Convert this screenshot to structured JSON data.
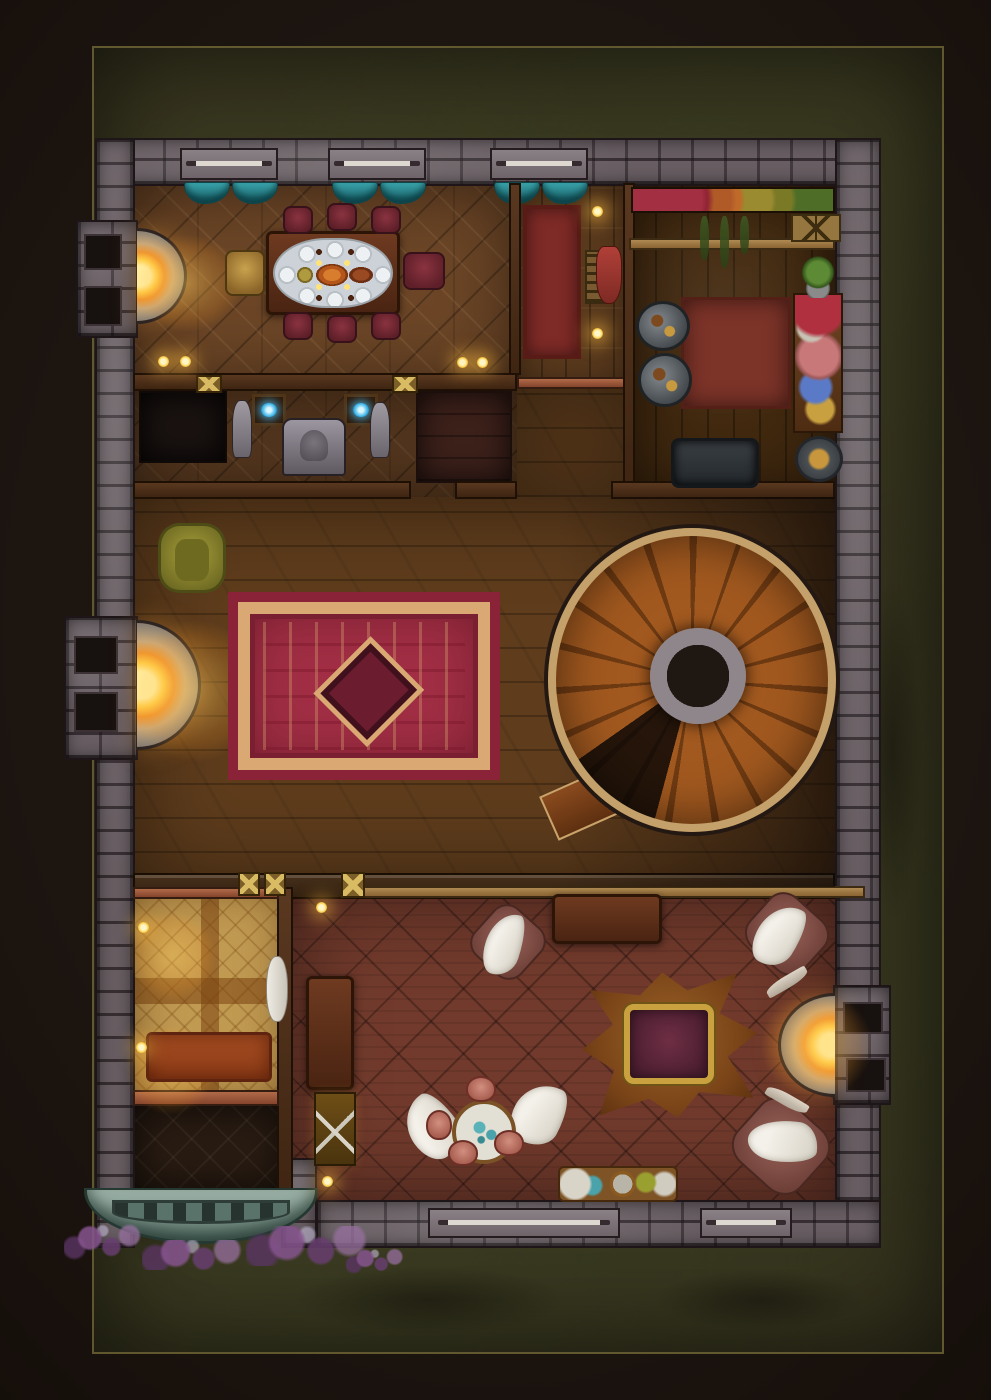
{
  "scene": {
    "title": "Top-down fantasy battle map: tavern-manor ground floor at night",
    "canvas": {
      "width": 991,
      "height": 1400
    },
    "rooms": [
      "dining room with set table",
      "hallway with red runner",
      "kitchen",
      "shrine corridor with orb paintings",
      "living room with large rug and spiral staircase",
      "bedroom with golden parquet",
      "entry vestibule with stone porch",
      "trophy lounge with bear rug, throne and round table"
    ]
  },
  "palette": {
    "background": "#120c08",
    "grass": "#36331e",
    "stone_wall": "#675d62",
    "dining_parquet": "#6b4526",
    "living_floor": "#5e3c1c",
    "tavern_floor": "#713a2c",
    "bedroom_floor": "#c19a52",
    "rug_red": "#a12e44",
    "rug_trim": "#d9a873",
    "runner_red": "#7e2a26",
    "curtain_teal": "#2e8f96",
    "fire_glow": "#ffc93e",
    "chair_maroon": "#7c2a33",
    "chair_gold": "#b9903f",
    "armchair_green": "#97922f",
    "stair_wood": "#a2591f",
    "stair_rim": "#c4a06a",
    "porch_stone": "#8ba399",
    "vine_purple": "#7a5070",
    "orb_blue": "#49b8e8",
    "animal_white": "#f2efe8",
    "throne_gold": "#c9a23f",
    "bear_rug": "#8a5120"
  },
  "regions": [
    {
      "n": "ground-grass",
      "c": "grass",
      "x": 92,
      "y": 46,
      "w": 852,
      "h": 1308
    },
    {
      "n": "grass-patch",
      "c": "grass-patch",
      "x": 110,
      "y": 220,
      "w": 200,
      "h": 260
    },
    {
      "n": "grass-patch",
      "c": "grass-patch",
      "x": 650,
      "y": 180,
      "w": 240,
      "h": 300
    },
    {
      "n": "grass-patch",
      "c": "grass-patch",
      "x": 120,
      "y": 760,
      "w": 150,
      "h": 360
    },
    {
      "n": "grass-patch",
      "c": "grass-patch",
      "x": 852,
      "y": 520,
      "w": 80,
      "h": 460
    },
    {
      "n": "grass-patch",
      "c": "grass-patch",
      "x": 250,
      "y": 1255,
      "w": 360,
      "h": 90
    },
    {
      "n": "grass-patch",
      "c": "grass-patch",
      "x": 620,
      "y": 1260,
      "w": 280,
      "h": 80
    },
    {
      "n": "grass-patch",
      "c": "grass-patch",
      "x": 96,
      "y": 1060,
      "w": 120,
      "h": 240
    },
    {
      "n": "floor-dining-room",
      "c": "floor-parquet",
      "x": 133,
      "y": 183,
      "w": 384,
      "h": 206
    },
    {
      "n": "floor-hallway",
      "c": "floor-planks",
      "x": 517,
      "y": 183,
      "w": 112,
      "h": 206
    },
    {
      "n": "floor-kitchen",
      "c": "floor-kitchen",
      "x": 629,
      "y": 183,
      "w": 206,
      "h": 314
    },
    {
      "n": "floor-shrine-corridor",
      "c": "floor-parquet dark",
      "x": 133,
      "y": 389,
      "w": 384,
      "h": 108
    },
    {
      "n": "floor-landing",
      "c": "floor-living",
      "x": 517,
      "y": 389,
      "w": 112,
      "h": 108
    },
    {
      "n": "floor-living-room",
      "c": "floor-living",
      "x": 133,
      "y": 497,
      "w": 702,
      "h": 390
    },
    {
      "n": "floor-bedroom",
      "c": "floor-bedroom",
      "x": 133,
      "y": 887,
      "w": 154,
      "h": 217
    },
    {
      "n": "floor-vestibule",
      "c": "floor-vestibule",
      "x": 133,
      "y": 1104,
      "w": 154,
      "h": 88
    },
    {
      "n": "floor-tavern-lounge",
      "c": "floor-tavern",
      "x": 287,
      "y": 887,
      "w": 548,
      "h": 317
    },
    {
      "n": "floor-closet",
      "c": "floor-dark",
      "x": 139,
      "y": 391,
      "w": 88,
      "h": 72
    },
    {
      "n": "floor-storage-room",
      "c": "floor-darkred",
      "x": 416,
      "y": 391,
      "w": 96,
      "h": 92
    },
    {
      "n": "wall-north",
      "c": "wall-stone",
      "x": 95,
      "y": 138,
      "w": 786,
      "h": 48
    },
    {
      "n": "wall-west",
      "c": "wall-stone",
      "x": 95,
      "y": 138,
      "w": 40,
      "h": 1110
    },
    {
      "n": "wall-east",
      "c": "wall-stone",
      "x": 835,
      "y": 138,
      "w": 46,
      "h": 1110
    },
    {
      "n": "wall-south",
      "c": "wall-stone",
      "x": 316,
      "y": 1200,
      "w": 565,
      "h": 48
    },
    {
      "n": "chimney-dining",
      "c": "wall-stone",
      "x": 76,
      "y": 220,
      "w": 62,
      "h": 118
    },
    {
      "n": "chimney-living",
      "c": "wall-stone",
      "x": 64,
      "y": 616,
      "w": 74,
      "h": 144
    },
    {
      "n": "chimney-tavern",
      "c": "wall-stone",
      "x": 833,
      "y": 985,
      "w": 58,
      "h": 120
    },
    {
      "n": "stone-post-door",
      "c": "wall-stone",
      "x": 281,
      "y": 1158,
      "w": 36,
      "h": 90
    },
    {
      "n": "flue",
      "c": "flue",
      "x": 84,
      "y": 234,
      "w": 38,
      "h": 36
    },
    {
      "n": "flue",
      "c": "flue",
      "x": 84,
      "y": 286,
      "w": 38,
      "h": 40
    },
    {
      "n": "flue",
      "c": "flue",
      "x": 74,
      "y": 636,
      "w": 44,
      "h": 38
    },
    {
      "n": "flue",
      "c": "flue",
      "x": 74,
      "y": 692,
      "w": 44,
      "h": 40
    },
    {
      "n": "flue",
      "c": "flue",
      "x": 843,
      "y": 1002,
      "w": 40,
      "h": 32
    },
    {
      "n": "flue",
      "c": "flue",
      "x": 846,
      "y": 1058,
      "w": 40,
      "h": 34
    },
    {
      "n": "window-north-1",
      "c": "window-sill",
      "x": 180,
      "y": 148,
      "w": 98,
      "h": 32
    },
    {
      "n": "window-north-2",
      "c": "window-sill",
      "x": 328,
      "y": 148,
      "w": 98,
      "h": 32
    },
    {
      "n": "window-north-3",
      "c": "window-sill",
      "x": 490,
      "y": 148,
      "w": 98,
      "h": 32
    },
    {
      "n": "window-south-1",
      "c": "window-sill",
      "x": 428,
      "y": 1208,
      "w": 192,
      "h": 30
    },
    {
      "n": "window-south-2",
      "c": "window-sill",
      "x": 700,
      "y": 1208,
      "w": 92,
      "h": 30
    },
    {
      "n": "curtain",
      "c": "curtain",
      "x": 184,
      "y": 182,
      "w": 46,
      "h": 22
    },
    {
      "n": "curtain",
      "c": "curtain",
      "x": 232,
      "y": 182,
      "w": 46,
      "h": 22
    },
    {
      "n": "curtain",
      "c": "curtain",
      "x": 332,
      "y": 182,
      "w": 46,
      "h": 22
    },
    {
      "n": "curtain",
      "c": "curtain",
      "x": 380,
      "y": 182,
      "w": 46,
      "h": 22
    },
    {
      "n": "curtain",
      "c": "curtain",
      "x": 494,
      "y": 182,
      "w": 46,
      "h": 22
    },
    {
      "n": "curtain",
      "c": "curtain",
      "x": 542,
      "y": 182,
      "w": 46,
      "h": 22
    },
    {
      "n": "wall-dining-south",
      "c": "wall-wood",
      "x": 133,
      "y": 373,
      "w": 384,
      "h": 18
    },
    {
      "n": "beam-hallway",
      "c": "beam-copper",
      "x": 517,
      "y": 377,
      "w": 112,
      "h": 12
    },
    {
      "n": "wall-dining-hallway",
      "c": "wall-wood",
      "x": 509,
      "y": 183,
      "w": 12,
      "h": 192
    },
    {
      "n": "wall-hallway-kitchen",
      "c": "wall-wood",
      "x": 623,
      "y": 183,
      "w": 12,
      "h": 314
    },
    {
      "n": "beam-kitchen-counter",
      "c": "beam-tan",
      "x": 629,
      "y": 238,
      "w": 206,
      "h": 12
    },
    {
      "n": "wall-corridor-south-a",
      "c": "wall-wood",
      "x": 133,
      "y": 481,
      "w": 278,
      "h": 18
    },
    {
      "n": "wall-corridor-south-b",
      "c": "wall-wood",
      "x": 455,
      "y": 481,
      "w": 62,
      "h": 18
    },
    {
      "n": "wall-kitchen-south",
      "c": "wall-wood",
      "x": 611,
      "y": 481,
      "w": 224,
      "h": 18
    },
    {
      "n": "wall-living-south",
      "c": "wall-wood-dark",
      "x": 133,
      "y": 873,
      "w": 702,
      "h": 26
    },
    {
      "n": "beam-tavern",
      "c": "beam-tan",
      "x": 341,
      "y": 886,
      "w": 524,
      "h": 12
    },
    {
      "n": "wall-bedroom-tavern",
      "c": "wall-wood",
      "x": 277,
      "y": 887,
      "w": 16,
      "h": 317
    },
    {
      "n": "trim-bedroom-north",
      "c": "beam-copper",
      "x": 133,
      "y": 887,
      "w": 146,
      "h": 12
    },
    {
      "n": "trim-bedroom-south",
      "c": "beam-copper",
      "x": 133,
      "y": 1090,
      "w": 146,
      "h": 16
    },
    {
      "n": "wall-post-ornament",
      "c": "post-gold",
      "x": 196,
      "y": 375,
      "w": 26,
      "h": 18
    },
    {
      "n": "wall-post-ornament",
      "c": "post-gold",
      "x": 392,
      "y": 375,
      "w": 26,
      "h": 18
    },
    {
      "n": "wall-post-ornament",
      "c": "post-gold",
      "x": 238,
      "y": 872,
      "w": 22,
      "h": 24
    },
    {
      "n": "wall-post-ornament",
      "c": "post-gold",
      "x": 264,
      "y": 872,
      "w": 22,
      "h": 24
    },
    {
      "n": "wall-post-ornament",
      "c": "post-gold",
      "x": 341,
      "y": 872,
      "w": 24,
      "h": 26
    }
  ],
  "items": [
    {
      "n": "fireplace-dining",
      "c": "hearth-right",
      "x": 137,
      "y": 228,
      "w": 50,
      "h": 96
    },
    {
      "n": "fire-glow-dining",
      "c": "light-glow",
      "x": 112,
      "y": 218,
      "w": 150,
      "h": 130
    },
    {
      "n": "dining-table",
      "c": "table-wood",
      "x": 266,
      "y": 231,
      "w": 134,
      "h": 84
    },
    {
      "n": "dining-tablecloth",
      "c": "cloth",
      "x": 273,
      "y": 238,
      "w": 120,
      "h": 70
    },
    {
      "n": "dining-chair",
      "c": "chair-maroon",
      "x": 283,
      "y": 206,
      "w": 30,
      "h": 28
    },
    {
      "n": "dining-chair",
      "c": "chair-maroon",
      "x": 327,
      "y": 203,
      "w": 30,
      "h": 28
    },
    {
      "n": "dining-chair",
      "c": "chair-maroon",
      "x": 371,
      "y": 206,
      "w": 30,
      "h": 28
    },
    {
      "n": "dining-chair",
      "c": "chair-maroon",
      "x": 283,
      "y": 312,
      "w": 30,
      "h": 28
    },
    {
      "n": "dining-chair",
      "c": "chair-maroon",
      "x": 327,
      "y": 315,
      "w": 30,
      "h": 28
    },
    {
      "n": "dining-chair",
      "c": "chair-maroon",
      "x": 371,
      "y": 312,
      "w": 30,
      "h": 28
    },
    {
      "n": "dining-armchair",
      "c": "chair-maroon",
      "x": 403,
      "y": 252,
      "w": 42,
      "h": 38
    },
    {
      "n": "dining-head-chair",
      "c": "chair-gold",
      "x": 225,
      "y": 250,
      "w": 40,
      "h": 46
    },
    {
      "n": "wall-candle",
      "c": "candle",
      "x": 158,
      "y": 356,
      "w": 11,
      "h": 11
    },
    {
      "n": "wall-candle",
      "c": "candle",
      "x": 180,
      "y": 356,
      "w": 11,
      "h": 11
    },
    {
      "n": "wall-candle",
      "c": "candle",
      "x": 457,
      "y": 357,
      "w": 11,
      "h": 11
    },
    {
      "n": "wall-candle",
      "c": "candle",
      "x": 477,
      "y": 357,
      "w": 11,
      "h": 11
    },
    {
      "n": "runner-rug",
      "c": "rug-runner",
      "x": 523,
      "y": 205,
      "w": 58,
      "h": 154
    },
    {
      "n": "shelf-rack",
      "c": "rack-shelf",
      "x": 585,
      "y": 250,
      "w": 26,
      "h": 54
    },
    {
      "n": "wall-candle",
      "c": "candle",
      "x": 592,
      "y": 206,
      "w": 11,
      "h": 11
    },
    {
      "n": "wall-candle",
      "c": "candle",
      "x": 592,
      "y": 328,
      "w": 11,
      "h": 11
    },
    {
      "n": "kitchen-food-shelf",
      "c": "shelf-food",
      "x": 631,
      "y": 187,
      "w": 204,
      "h": 26
    },
    {
      "n": "hanging-herb",
      "c": "herb",
      "x": 700,
      "y": 216,
      "w": 9,
      "h": 44
    },
    {
      "n": "hanging-herb",
      "c": "herb",
      "x": 720,
      "y": 216,
      "w": 9,
      "h": 52
    },
    {
      "n": "hanging-herb",
      "c": "herb",
      "x": 740,
      "y": 216,
      "w": 9,
      "h": 38
    },
    {
      "n": "crates",
      "c": "crate",
      "x": 791,
      "y": 214,
      "w": 50,
      "h": 28
    },
    {
      "n": "hanging-cloth",
      "c": "cloth-red",
      "x": 596,
      "y": 246,
      "w": 26,
      "h": 58
    },
    {
      "n": "kitchen-rug",
      "c": "rug-square",
      "x": 681,
      "y": 297,
      "w": 110,
      "h": 112
    },
    {
      "n": "stove-pot",
      "c": "stove",
      "x": 636,
      "y": 301,
      "w": 54,
      "h": 50
    },
    {
      "n": "stove-pot",
      "c": "stove",
      "x": 638,
      "y": 353,
      "w": 54,
      "h": 54
    },
    {
      "n": "prep-table",
      "c": "prep-table",
      "x": 793,
      "y": 293,
      "w": 50,
      "h": 140
    },
    {
      "n": "potted-plant",
      "c": "plant",
      "x": 795,
      "y": 254,
      "w": 46,
      "h": 44
    },
    {
      "n": "sink-basin",
      "c": "sink",
      "x": 671,
      "y": 438,
      "w": 88,
      "h": 50
    },
    {
      "n": "cook-pot",
      "c": "pot-round",
      "x": 795,
      "y": 436,
      "w": 48,
      "h": 46
    },
    {
      "n": "orb-painting",
      "c": "orb-art",
      "x": 252,
      "y": 394,
      "w": 34,
      "h": 32
    },
    {
      "n": "orb-painting",
      "c": "orb-art",
      "x": 344,
      "y": 394,
      "w": 34,
      "h": 32
    },
    {
      "n": "statue",
      "c": "statue",
      "x": 232,
      "y": 400,
      "w": 20,
      "h": 58
    },
    {
      "n": "statue",
      "c": "statue",
      "x": 370,
      "y": 402,
      "w": 20,
      "h": 56
    },
    {
      "n": "shrine-fountain",
      "c": "shrine",
      "x": 282,
      "y": 418,
      "w": 64,
      "h": 58
    },
    {
      "n": "armchair-green",
      "c": "chair-green",
      "x": 158,
      "y": 523,
      "w": 68,
      "h": 70
    },
    {
      "n": "fireplace-living",
      "c": "hearth-right",
      "x": 137,
      "y": 620,
      "w": 64,
      "h": 130
    },
    {
      "n": "fire-glow-living",
      "c": "light-glow",
      "x": 100,
      "y": 596,
      "w": 190,
      "h": 190
    },
    {
      "n": "large-rug",
      "c": "rug-large",
      "x": 228,
      "y": 592,
      "w": 272,
      "h": 188
    },
    {
      "n": "living-shade",
      "c": "shade",
      "x": 556,
      "y": 497,
      "w": 279,
      "h": 390
    },
    {
      "n": "stair-shadow",
      "c": "shadow-blob",
      "x": 536,
      "y": 496,
      "w": 324,
      "h": 376
    },
    {
      "n": "stair-entry-step",
      "c": "stair-entry",
      "x": 544,
      "y": 772,
      "w": 112,
      "h": 48,
      "r": -24
    },
    {
      "n": "spiral-staircase",
      "c": "stair-spiral",
      "x": 548,
      "y": 528,
      "w": 288,
      "h": 304
    },
    {
      "n": "stair-center-column",
      "c": "stair-column",
      "x": 650,
      "y": 628,
      "w": 96,
      "h": 96
    },
    {
      "n": "candle-glow",
      "c": "light-glow",
      "x": 112,
      "y": 896,
      "w": 120,
      "h": 120
    },
    {
      "n": "candle-glow",
      "c": "light-glow",
      "x": 110,
      "y": 1010,
      "w": 120,
      "h": 120
    },
    {
      "n": "bed",
      "c": "bed",
      "x": 146,
      "y": 1032,
      "w": 126,
      "h": 50
    },
    {
      "n": "bedroll",
      "c": "bedroll",
      "x": 266,
      "y": 956,
      "w": 22,
      "h": 66
    },
    {
      "n": "wall-candle",
      "c": "candle",
      "x": 138,
      "y": 922,
      "w": 11,
      "h": 11
    },
    {
      "n": "wall-candle",
      "c": "candle",
      "x": 136,
      "y": 1042,
      "w": 11,
      "h": 11
    },
    {
      "n": "porch-steps",
      "c": "porch",
      "x": 84,
      "y": 1188,
      "w": 234,
      "h": 56
    },
    {
      "n": "vine-cluster",
      "c": "vine",
      "x": 64,
      "y": 1222,
      "w": 86,
      "h": 40
    },
    {
      "n": "vine-cluster",
      "c": "vine",
      "x": 142,
      "y": 1240,
      "w": 112,
      "h": 30
    },
    {
      "n": "vine-cluster",
      "c": "vine",
      "x": 246,
      "y": 1226,
      "w": 136,
      "h": 40
    },
    {
      "n": "vine-cluster",
      "c": "vine",
      "x": 346,
      "y": 1248,
      "w": 64,
      "h": 26
    },
    {
      "n": "wall-torch",
      "c": "candle",
      "x": 316,
      "y": 902,
      "w": 11,
      "h": 11
    },
    {
      "n": "wall-torch",
      "c": "candle",
      "x": 322,
      "y": 1176,
      "w": 11,
      "h": 11
    },
    {
      "n": "bar-table",
      "c": "table-wood",
      "x": 552,
      "y": 894,
      "w": 110,
      "h": 50
    },
    {
      "n": "side-bench",
      "c": "table-wood",
      "x": 306,
      "y": 976,
      "w": 48,
      "h": 114
    },
    {
      "n": "weapon-case",
      "c": "weapon-case",
      "x": 314,
      "y": 1092,
      "w": 42,
      "h": 74
    },
    {
      "n": "floor-cushion",
      "c": "cushion",
      "x": 476,
      "y": 910,
      "w": 64,
      "h": 64
    },
    {
      "n": "floor-cushion",
      "c": "cushion",
      "x": 750,
      "y": 900,
      "w": 74,
      "h": 68
    },
    {
      "n": "floor-cushion",
      "c": "cushion",
      "x": 738,
      "y": 1106,
      "w": 86,
      "h": 80
    },
    {
      "n": "white-animal",
      "c": "animal",
      "x": 486,
      "y": 912,
      "w": 36,
      "h": 64,
      "r": 18
    },
    {
      "n": "white-animal",
      "c": "animal",
      "x": 758,
      "y": 902,
      "w": 42,
      "h": 66,
      "r": 32
    },
    {
      "n": "white-animal",
      "c": "animal",
      "x": 748,
      "y": 1120,
      "w": 70,
      "h": 42,
      "r": 8
    },
    {
      "n": "white-animal",
      "c": "animal",
      "x": 408,
      "y": 1094,
      "w": 48,
      "h": 66,
      "r": -35
    },
    {
      "n": "white-animal",
      "c": "animal",
      "x": 514,
      "y": 1082,
      "w": 50,
      "h": 64,
      "r": 28
    },
    {
      "n": "round-table",
      "c": "round-table",
      "x": 452,
      "y": 1100,
      "w": 64,
      "h": 64
    },
    {
      "n": "pink-chair",
      "c": "chair-pink",
      "x": 466,
      "y": 1076,
      "w": 30,
      "h": 26
    },
    {
      "n": "pink-chair",
      "c": "chair-pink",
      "x": 426,
      "y": 1110,
      "w": 26,
      "h": 30
    },
    {
      "n": "pink-chair",
      "c": "chair-pink",
      "x": 448,
      "y": 1140,
      "w": 30,
      "h": 26
    },
    {
      "n": "pink-chair",
      "c": "chair-pink",
      "x": 494,
      "y": 1130,
      "w": 30,
      "h": 26
    },
    {
      "n": "bear-rug",
      "c": "bear-rug",
      "x": 582,
      "y": 972,
      "w": 176,
      "h": 146,
      "r": -6
    },
    {
      "n": "throne",
      "c": "throne",
      "x": 624,
      "y": 1004,
      "w": 90,
      "h": 80
    },
    {
      "n": "fireplace-tavern",
      "c": "hearth-left",
      "x": 778,
      "y": 993,
      "w": 57,
      "h": 104
    },
    {
      "n": "fire-glow-tavern",
      "c": "light-glow",
      "x": 742,
      "y": 975,
      "w": 150,
      "h": 140
    },
    {
      "n": "antler",
      "c": "antler",
      "x": 764,
      "y": 976,
      "w": 46,
      "h": 12,
      "r": -30
    },
    {
      "n": "antler",
      "c": "antler",
      "x": 764,
      "y": 1094,
      "w": 46,
      "h": 12,
      "r": 30
    },
    {
      "n": "serving-tray",
      "c": "tray",
      "x": 558,
      "y": 1166,
      "w": 120,
      "h": 36
    }
  ]
}
